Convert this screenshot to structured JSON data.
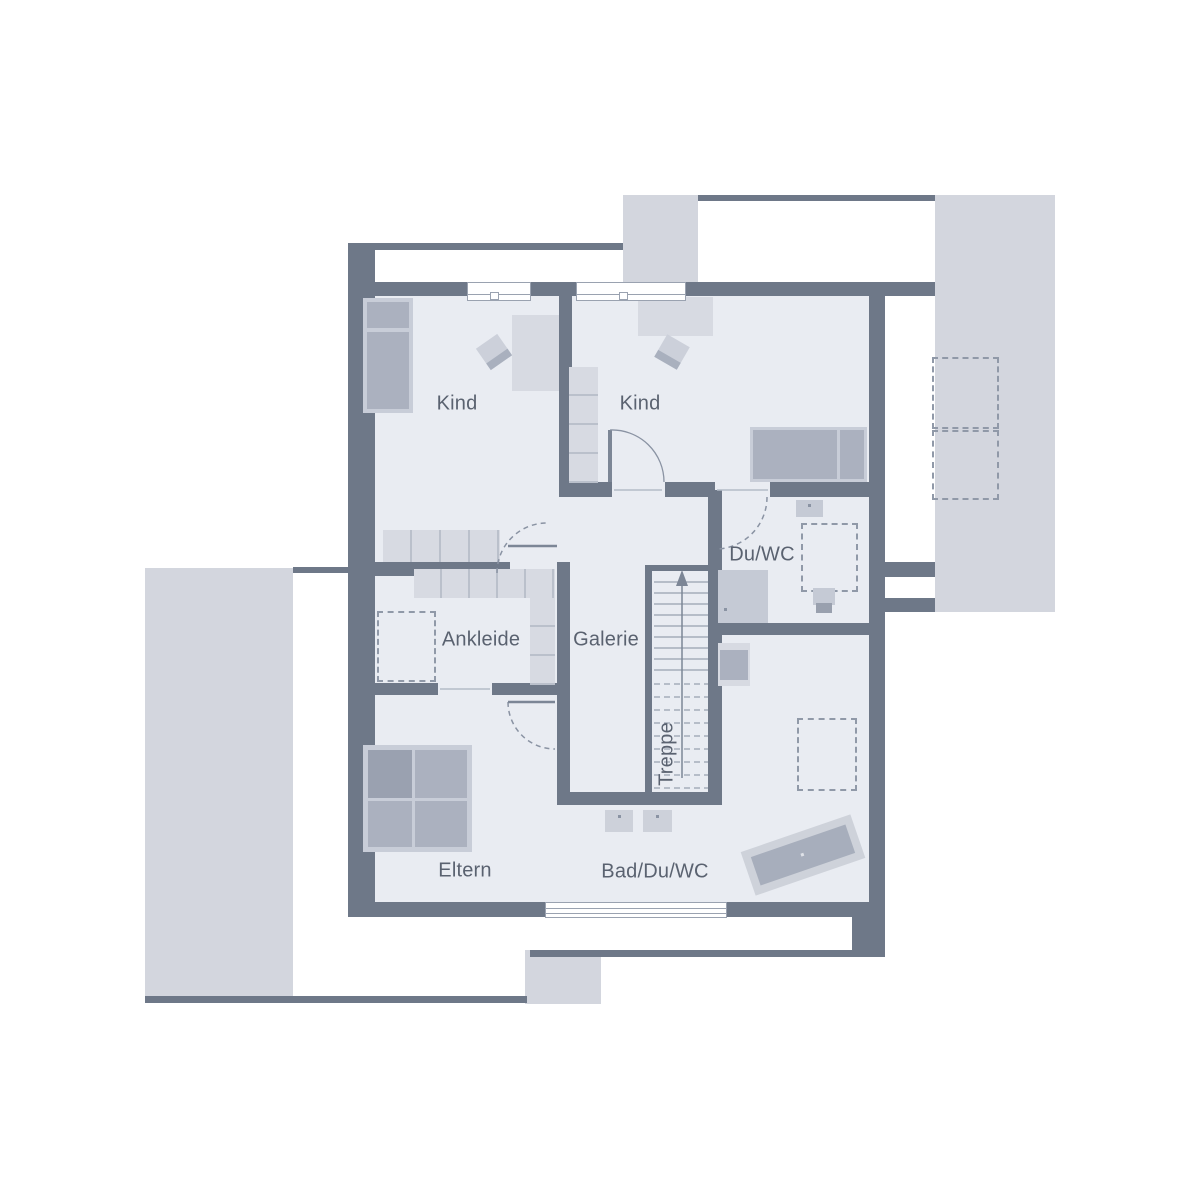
{
  "rooms": {
    "kind_left": "Kind",
    "kind_right": "Kind",
    "du_wc": "Du/WC",
    "ankleide": "Ankleide",
    "galerie": "Galerie",
    "treppe": "Treppe",
    "eltern": "Eltern",
    "bad_du_wc": "Bad/Du/WC"
  },
  "colors": {
    "wall": "#6e7888",
    "floor": "#e9ecf2",
    "exterior_roof": "#d3d6de",
    "furniture_light": "#d7dae2",
    "furniture_medium": "#c8cdd8",
    "furniture_dark": "#abb1bf",
    "fixture": "#c5cad5",
    "label_text": "#5a6270",
    "line": "#8a93a3"
  }
}
